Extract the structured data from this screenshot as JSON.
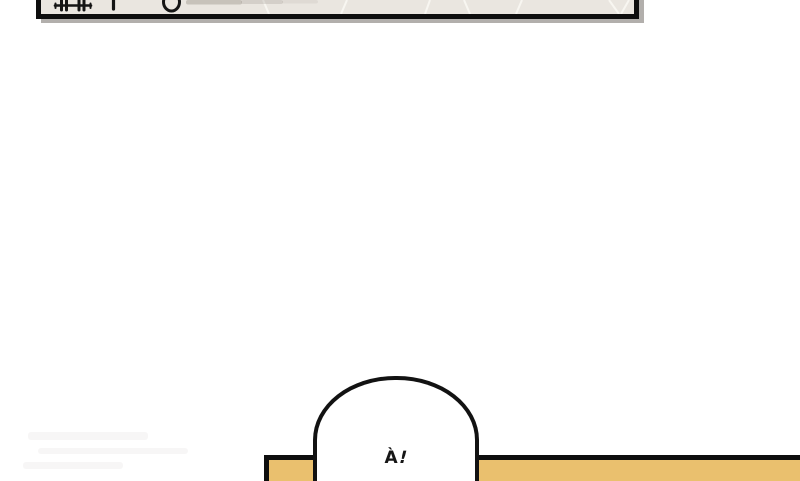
{
  "scene": {
    "background_color": "#ffffff",
    "ink_color": "#0e0e0e"
  },
  "top_panel": {
    "background_color": "#eae6e0",
    "border_color": "#0e0e0e",
    "shadow_color": "#b2afac",
    "crease_color": "#f8f6f1",
    "partial_glyphs": [
      "track-glyph",
      "stem-glyph",
      "ring-glyph",
      "faded-smudge"
    ]
  },
  "floor_bar": {
    "fill_color": "#eac06e",
    "border_color": "#0e0e0e"
  },
  "speech_bubble": {
    "text": "À!",
    "text_a": "À",
    "text_exclaim": "!",
    "fill_color": "#ffffff",
    "border_color": "#121212"
  }
}
